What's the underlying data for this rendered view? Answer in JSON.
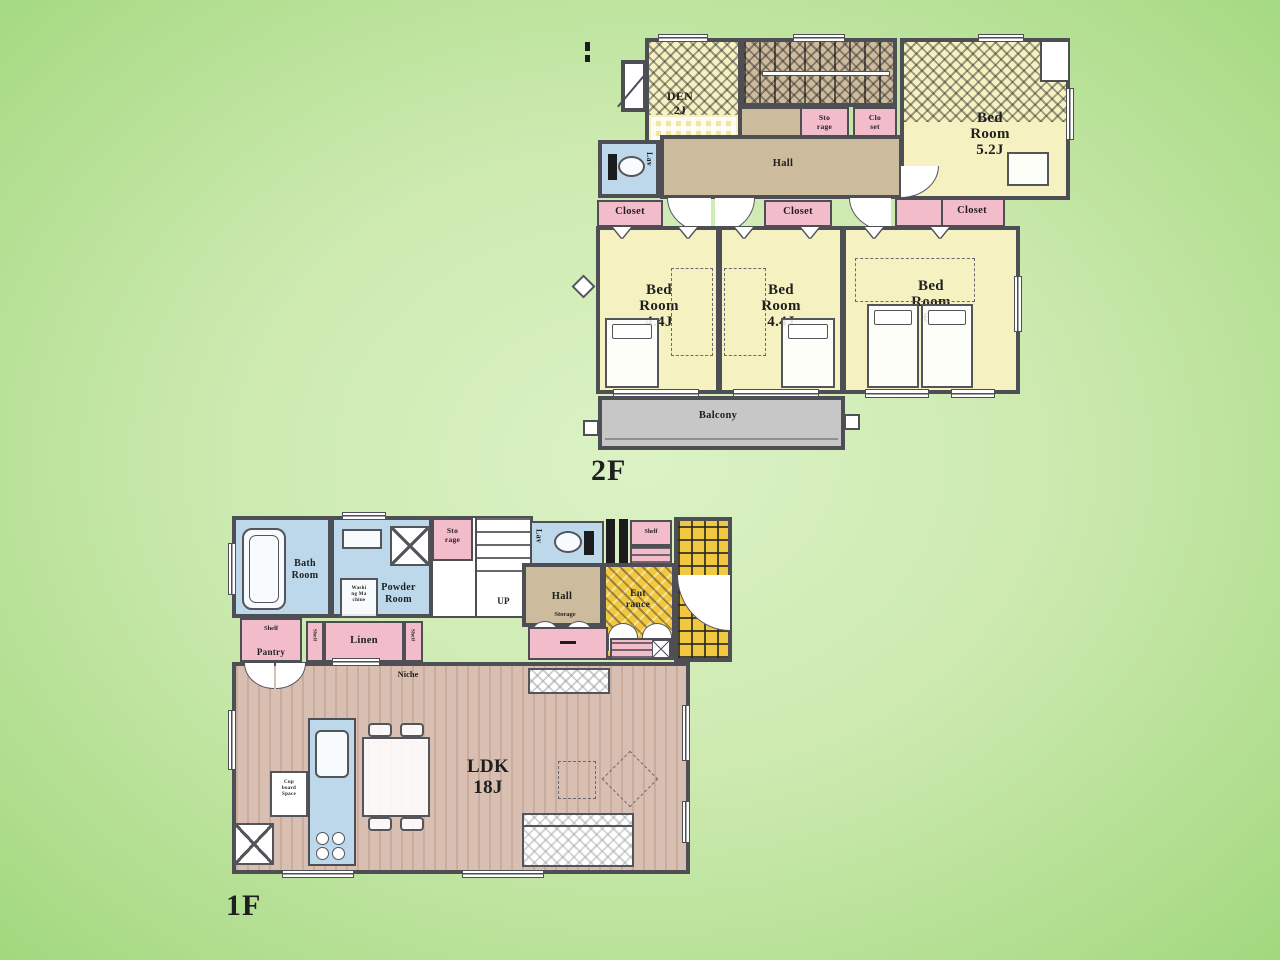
{
  "colors": {
    "bg_center": "#dcf2c6",
    "bg_edge": "#a2d87e",
    "wall": "#4e4e55",
    "cream": "#f6f1c1",
    "pink": "#f3bccb",
    "tan": "#cdbb9d",
    "blue": "#bcd8ea",
    "yellow": "#f2c840",
    "gray": "#c7c7c7",
    "wood": "#d8bfb1",
    "ink": "#1f1f1f"
  },
  "floor2": {
    "label": "2F",
    "den": {
      "l1": "DEN",
      "l2": "2J"
    },
    "storage_sm": {
      "l1": "Sto",
      "l2": "rage"
    },
    "closet_sm": {
      "l1": "Clo",
      "l2": "set"
    },
    "bed52": {
      "l1": "Bed",
      "l2": "Room",
      "l3": "5.2J"
    },
    "hall": "Hall",
    "lav": "Lav",
    "closet_a": "Closet",
    "closet_b": "Closet",
    "closet_c": "Closet",
    "bed44a": {
      "l1": "Bed",
      "l2": "Room",
      "l3": "4.4J"
    },
    "bed44b": {
      "l1": "Bed",
      "l2": "Room",
      "l3": "4.4J"
    },
    "bed6": {
      "l1": "Bed",
      "l2": "Room",
      "l3": "6J"
    },
    "balcony": "Balcony"
  },
  "floor1": {
    "label": "1F",
    "bath": {
      "l1": "Bath",
      "l2": "Room"
    },
    "powder": {
      "l1": "Powder",
      "l2": "Room"
    },
    "storage_sm": {
      "l1": "Sto",
      "l2": "rage"
    },
    "washer_note": {
      "l1": "Washi",
      "l2": "ng Ma",
      "l3": "chine"
    },
    "up": "UP",
    "lav": "Lav",
    "shelf_top": "Shelf",
    "hall": "Hall",
    "entrance": {
      "l1": "Ent",
      "l2": "rance"
    },
    "pantry": {
      "shelf": "Shelf",
      "name": "Pantry"
    },
    "shelf_v1": "Shelf",
    "shelf_v2": "Shelf",
    "linen": "Linen",
    "storage_note": "Storage",
    "niche": "Niche",
    "ldk": {
      "l1": "LDK",
      "l2": "18J"
    },
    "cupboard_note": {
      "l1": "Cup",
      "l2": "board",
      "l3": "Space"
    }
  }
}
